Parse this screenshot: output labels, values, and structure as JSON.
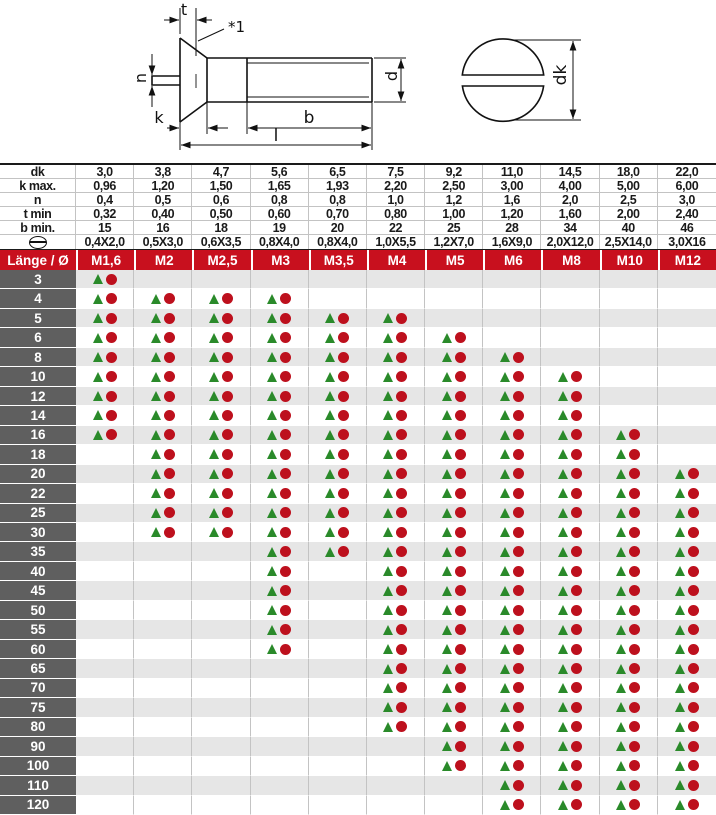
{
  "colors": {
    "header_red": "#c8101e",
    "row_label_gray": "#5f5f5f",
    "stripe_gray": "#e6e6e6",
    "stripe_white": "#ffffff",
    "marker_green": "#2a8a2a",
    "marker_red": "#bd101d",
    "grid_line": "#c3c3c3",
    "drawing_ink": "#111111"
  },
  "drawing": {
    "labels": {
      "t": "t",
      "note": "*1",
      "n": "n",
      "k": "k",
      "b": "b",
      "l": "l",
      "d": "d",
      "dk": "dk"
    }
  },
  "dim_table": {
    "rows": [
      {
        "label": "dk",
        "values": [
          "3,0",
          "3,8",
          "4,7",
          "5,6",
          "6,5",
          "7,5",
          "9,2",
          "11,0",
          "14,5",
          "18,0",
          "22,0"
        ]
      },
      {
        "label": "k max.",
        "values": [
          "0,96",
          "1,20",
          "1,50",
          "1,65",
          "1,93",
          "2,20",
          "2,50",
          "3,00",
          "4,00",
          "5,00",
          "6,00"
        ]
      },
      {
        "label": "n",
        "values": [
          "0,4",
          "0,5",
          "0,6",
          "0,8",
          "0,8",
          "1,0",
          "1,2",
          "1,6",
          "2,0",
          "2,5",
          "3,0"
        ]
      },
      {
        "label": "t min",
        "values": [
          "0,32",
          "0,40",
          "0,50",
          "0,60",
          "0,70",
          "0,80",
          "1,00",
          "1,20",
          "1,60",
          "2,00",
          "2,40"
        ]
      },
      {
        "label": "b min.",
        "values": [
          "15",
          "16",
          "18",
          "19",
          "20",
          "22",
          "25",
          "28",
          "34",
          "40",
          "46"
        ]
      },
      {
        "label": "",
        "icon": "slotted-head-icon",
        "values": [
          "0,4X2,0",
          "0,5X3,0",
          "0,6X3,5",
          "0,8X4,0",
          "0,8X4,0",
          "1,0X5,5",
          "1,2X7,0",
          "1,6X9,0",
          "2,0X12,0",
          "2,5X14,0",
          "3,0X16"
        ]
      }
    ]
  },
  "matrix": {
    "corner_label": "Länge / Ø",
    "columns": [
      "M1,6",
      "M2",
      "M2,5",
      "M3",
      "M3,5",
      "M4",
      "M5",
      "M6",
      "M8",
      "M10",
      "M12"
    ],
    "markers": {
      "triangle": "triangle-icon",
      "circle": "circle-icon"
    },
    "rows": [
      {
        "length": "3",
        "available": [
          1,
          0,
          0,
          0,
          0,
          0,
          0,
          0,
          0,
          0,
          0
        ]
      },
      {
        "length": "4",
        "available": [
          1,
          1,
          1,
          1,
          0,
          0,
          0,
          0,
          0,
          0,
          0
        ]
      },
      {
        "length": "5",
        "available": [
          1,
          1,
          1,
          1,
          1,
          1,
          0,
          0,
          0,
          0,
          0
        ]
      },
      {
        "length": "6",
        "available": [
          1,
          1,
          1,
          1,
          1,
          1,
          1,
          0,
          0,
          0,
          0
        ]
      },
      {
        "length": "8",
        "available": [
          1,
          1,
          1,
          1,
          1,
          1,
          1,
          1,
          0,
          0,
          0
        ]
      },
      {
        "length": "10",
        "available": [
          1,
          1,
          1,
          1,
          1,
          1,
          1,
          1,
          1,
          0,
          0
        ]
      },
      {
        "length": "12",
        "available": [
          1,
          1,
          1,
          1,
          1,
          1,
          1,
          1,
          1,
          0,
          0
        ]
      },
      {
        "length": "14",
        "available": [
          1,
          1,
          1,
          1,
          1,
          1,
          1,
          1,
          1,
          0,
          0
        ]
      },
      {
        "length": "16",
        "available": [
          1,
          1,
          1,
          1,
          1,
          1,
          1,
          1,
          1,
          1,
          0
        ]
      },
      {
        "length": "18",
        "available": [
          0,
          1,
          1,
          1,
          1,
          1,
          1,
          1,
          1,
          1,
          0
        ]
      },
      {
        "length": "20",
        "available": [
          0,
          1,
          1,
          1,
          1,
          1,
          1,
          1,
          1,
          1,
          1
        ]
      },
      {
        "length": "22",
        "available": [
          0,
          1,
          1,
          1,
          1,
          1,
          1,
          1,
          1,
          1,
          1
        ]
      },
      {
        "length": "25",
        "available": [
          0,
          1,
          1,
          1,
          1,
          1,
          1,
          1,
          1,
          1,
          1
        ]
      },
      {
        "length": "30",
        "available": [
          0,
          1,
          1,
          1,
          1,
          1,
          1,
          1,
          1,
          1,
          1
        ]
      },
      {
        "length": "35",
        "available": [
          0,
          0,
          0,
          1,
          1,
          1,
          1,
          1,
          1,
          1,
          1
        ]
      },
      {
        "length": "40",
        "available": [
          0,
          0,
          0,
          1,
          0,
          1,
          1,
          1,
          1,
          1,
          1
        ]
      },
      {
        "length": "45",
        "available": [
          0,
          0,
          0,
          1,
          0,
          1,
          1,
          1,
          1,
          1,
          1
        ]
      },
      {
        "length": "50",
        "available": [
          0,
          0,
          0,
          1,
          0,
          1,
          1,
          1,
          1,
          1,
          1
        ]
      },
      {
        "length": "55",
        "available": [
          0,
          0,
          0,
          1,
          0,
          1,
          1,
          1,
          1,
          1,
          1
        ]
      },
      {
        "length": "60",
        "available": [
          0,
          0,
          0,
          1,
          0,
          1,
          1,
          1,
          1,
          1,
          1
        ]
      },
      {
        "length": "65",
        "available": [
          0,
          0,
          0,
          0,
          0,
          1,
          1,
          1,
          1,
          1,
          1
        ]
      },
      {
        "length": "70",
        "available": [
          0,
          0,
          0,
          0,
          0,
          1,
          1,
          1,
          1,
          1,
          1
        ]
      },
      {
        "length": "75",
        "available": [
          0,
          0,
          0,
          0,
          0,
          1,
          1,
          1,
          1,
          1,
          1
        ]
      },
      {
        "length": "80",
        "available": [
          0,
          0,
          0,
          0,
          0,
          1,
          1,
          1,
          1,
          1,
          1
        ]
      },
      {
        "length": "90",
        "available": [
          0,
          0,
          0,
          0,
          0,
          0,
          1,
          1,
          1,
          1,
          1
        ]
      },
      {
        "length": "100",
        "available": [
          0,
          0,
          0,
          0,
          0,
          0,
          1,
          1,
          1,
          1,
          1
        ]
      },
      {
        "length": "110",
        "available": [
          0,
          0,
          0,
          0,
          0,
          0,
          0,
          1,
          1,
          1,
          1
        ]
      },
      {
        "length": "120",
        "available": [
          0,
          0,
          0,
          0,
          0,
          0,
          0,
          1,
          1,
          1,
          1
        ]
      }
    ]
  }
}
